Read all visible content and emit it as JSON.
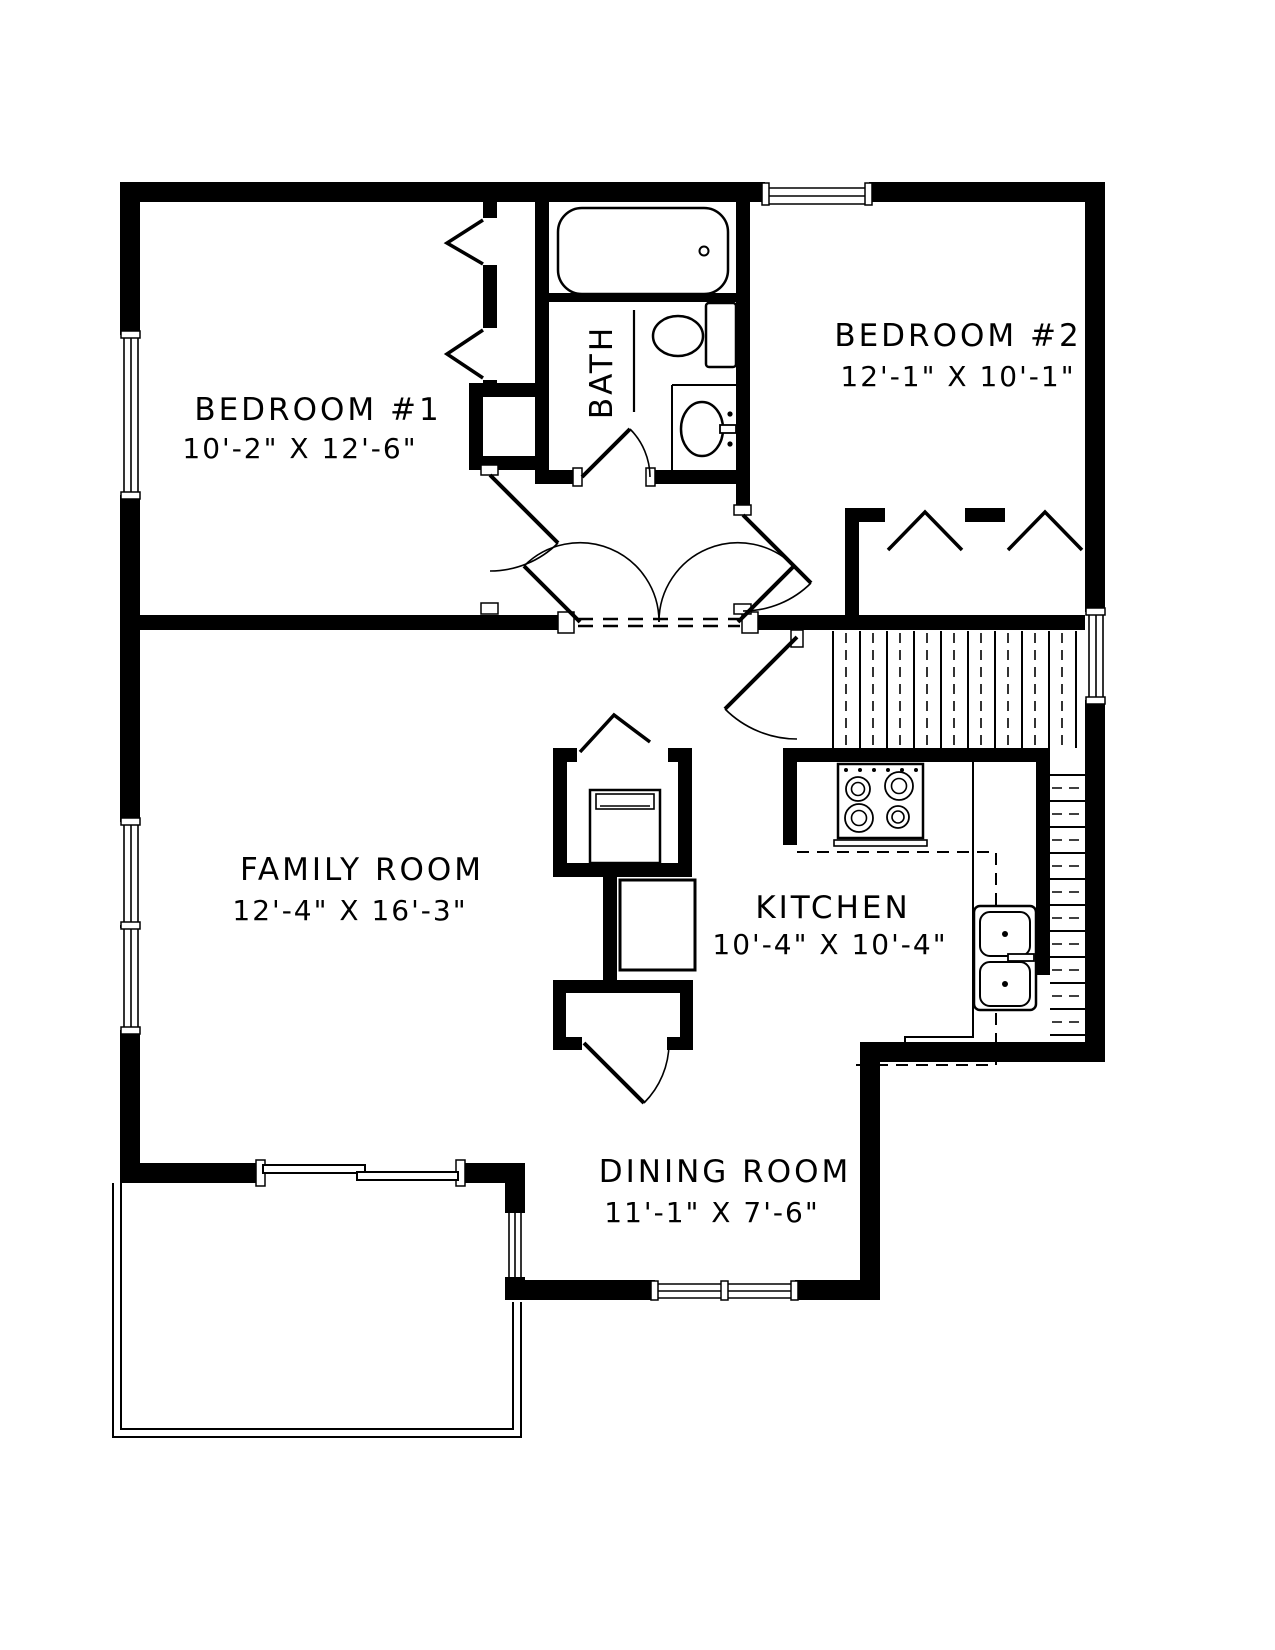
{
  "colors": {
    "ink": "#000000",
    "paper": "#ffffff"
  },
  "rooms": {
    "bedroom1": {
      "name": "BEDROOM #1",
      "dims": "10'-2\" X 12'-6\""
    },
    "bedroom2": {
      "name": "BEDROOM #2",
      "dims": "12'-1\" X 10'-1\""
    },
    "bath": {
      "name": "BATH"
    },
    "family": {
      "name": "FAMILY ROOM",
      "dims": "12'-4\" X 16'-3\""
    },
    "kitchen": {
      "name": "KITCHEN",
      "dims": "10'-4\" X 10'-4\""
    },
    "dining": {
      "name": "DINING ROOM",
      "dims": "11'-1\" X 7'-6\""
    }
  },
  "fixtures": {
    "bathtub": "bathtub",
    "toilet": "toilet",
    "vanity_sink": "bathroom-sink",
    "range": "cooktop-range",
    "kitchen_sink": "double-kitchen-sink",
    "stairs": "stairs",
    "appliance": "utility-appliance",
    "sliding_door": "sliding-patio-door",
    "deck": "deck"
  }
}
